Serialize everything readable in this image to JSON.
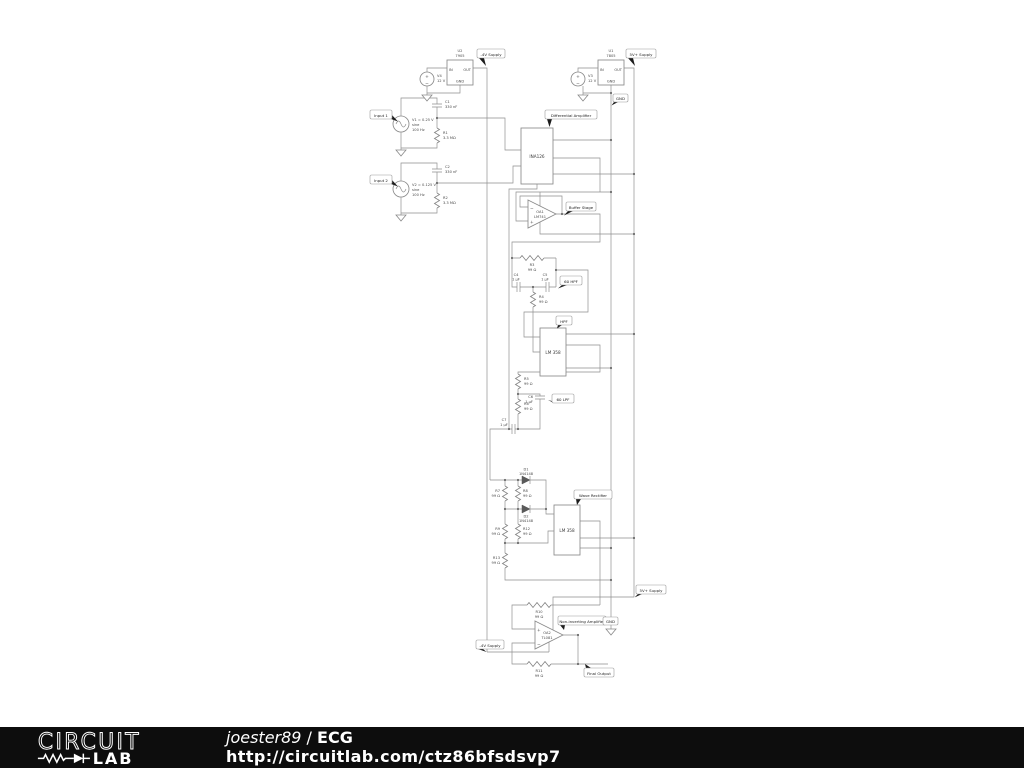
{
  "footer": {
    "logo_top": "CIRCUIT",
    "logo_bottom": "LAB",
    "author": "joester89",
    "separator": " / ",
    "title": "ECG",
    "url": "http://circuitlab.com/ctz86bfsdsvp7",
    "bg": "#0d0d0d",
    "fg": "#ffffff"
  },
  "flags": {
    "neg_supply": "-4V Supply",
    "pos_supply": "5V+ Supply",
    "gnd_top": "GND",
    "input1": "Input 1",
    "input2": "Input 2",
    "diff_amp": "Differential Amplifier",
    "buffer": "Buffer Stage",
    "hpf60": "60 HPF",
    "hpf": "HPF",
    "lpf60": "60 LPF",
    "rectifier": "Wave Rectifier",
    "noninv": "Non-inverting Amplifier",
    "neg_supply_bottom": "-4V Supply",
    "pos_supply_bottom": "5V+ Supply",
    "gnd_bottom": "GND",
    "final_output": "Final Output"
  },
  "sym": {
    "plus": "+",
    "minus": "−"
  },
  "components": {
    "u2": {
      "ref": "U2",
      "part": "7905",
      "pin_in": "IN",
      "pin_out": "OUT",
      "pin_gnd": "GND"
    },
    "v4": {
      "ref": "V4",
      "value": "12 V"
    },
    "u1": {
      "ref": "U1",
      "part": "7805",
      "pin_in": "IN",
      "pin_out": "OUT",
      "pin_gnd": "GND"
    },
    "v3": {
      "ref": "V3",
      "value": "12 V"
    },
    "v1": {
      "line1": "V1 = 0.25 V",
      "line2": "sine",
      "line3": "100 Hz"
    },
    "v2": {
      "line1": "V2 = 0.125 V",
      "line2": "sine",
      "line3": "100 Hz"
    },
    "c1": {
      "ref": "C1",
      "value": "330 nF"
    },
    "c2": {
      "ref": "C2",
      "value": "330 nF"
    },
    "r1": {
      "ref": "R1",
      "value": "3.3 MΩ"
    },
    "r2": {
      "ref": "R2",
      "value": "3.3 MΩ"
    },
    "ina": {
      "part": "INA126"
    },
    "oa1": {
      "ref": "OA1",
      "part": "LM741"
    },
    "r3": {
      "ref": "R3",
      "value": "99 Ω"
    },
    "r4": {
      "ref": "R4",
      "value": "99 Ω"
    },
    "c4": {
      "ref": "C4",
      "value": "1 µF"
    },
    "c5": {
      "ref": "C5",
      "value": "1 µF"
    },
    "op1": {
      "part": "LM 358"
    },
    "r5": {
      "ref": "R5",
      "value": "99 Ω"
    },
    "r6": {
      "ref": "R6",
      "value": "99 Ω"
    },
    "c6": {
      "ref": "C6",
      "value": "1 µF"
    },
    "c7": {
      "ref": "C7",
      "value": "1 µF"
    },
    "d1": {
      "ref": "D1",
      "value": "1N4148"
    },
    "d2": {
      "ref": "D2",
      "value": "1N4148"
    },
    "r7": {
      "ref": "R7",
      "value": "99 Ω"
    },
    "r8": {
      "ref": "R8",
      "value": "99 Ω"
    },
    "r9": {
      "ref": "R9",
      "value": "99 Ω"
    },
    "r12": {
      "ref": "R12",
      "value": "99 Ω"
    },
    "r13": {
      "ref": "R13",
      "value": "99 Ω"
    },
    "op2": {
      "part": "LM 358"
    },
    "r10": {
      "ref": "R10",
      "value": "99 Ω"
    },
    "oa2": {
      "ref": "OA2",
      "part": "TL081"
    },
    "r11": {
      "ref": "R11",
      "value": "99 Ω"
    }
  }
}
